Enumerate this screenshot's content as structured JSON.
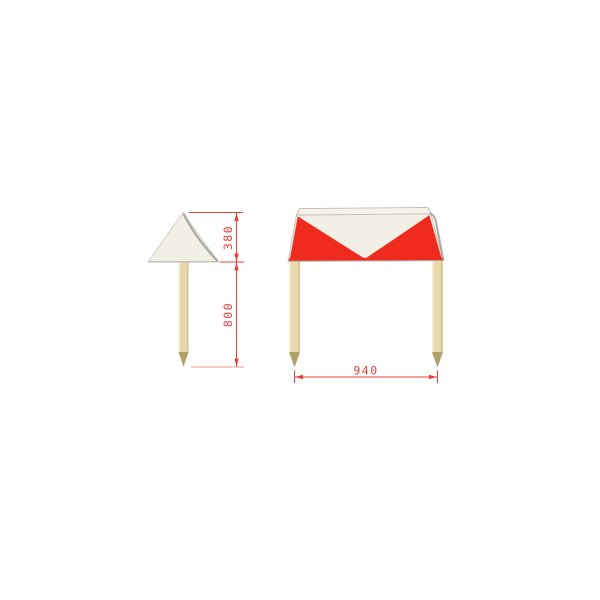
{
  "drawing": {
    "description": "Technical drawing of a red and white marker cover on wooden stakes, side view and front view",
    "side_view": {
      "dim_cone_height_label": "380",
      "dim_post_height_label": "800"
    },
    "front_view": {
      "dim_width_label": "940"
    }
  },
  "colors": {
    "red": "#ee2b1e",
    "panel": "#f2f0e5",
    "roof": "#f4f2e9",
    "post": "#e7d9ac",
    "post_edge": "#d2c190",
    "post_highlight": "#f6efd7",
    "post_tip": "#b1a166",
    "dimension": "#e8403a",
    "edge_shade": "#9e9e96",
    "edge_light": "#cfcfc8",
    "background": "#ffffff"
  }
}
